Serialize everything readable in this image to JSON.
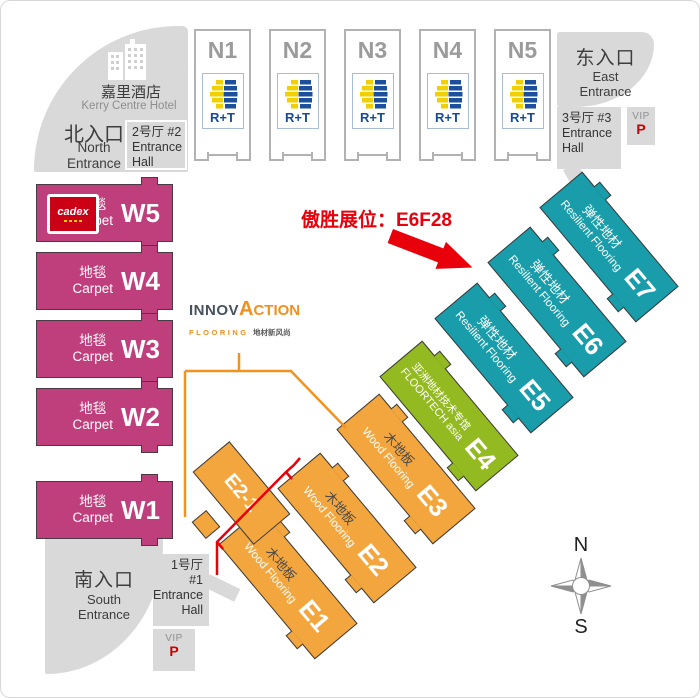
{
  "annotation": {
    "text": "傲胜展位：E6F28",
    "color": "#e8000b"
  },
  "hotel": {
    "zh": "嘉里酒店",
    "en": "Kerry Centre Hotel"
  },
  "entrances": {
    "north": {
      "zh": "北入口",
      "en_line1": "North",
      "en_line2": "Entrance"
    },
    "east": {
      "zh": "东入口",
      "en_line1": "East",
      "en_line2": "Entrance"
    },
    "south": {
      "zh": "南入口",
      "en_line1": "South",
      "en_line2": "Entrance"
    }
  },
  "entrance_halls": {
    "h2": {
      "line1": "2号厅  #2",
      "line2": "Entrance",
      "line3": "Hall"
    },
    "h3": {
      "line1": "3号厅  #3",
      "line2": "Entrance",
      "line3": "Hall"
    },
    "h1": {
      "line1": "1号厅",
      "line2": "#1",
      "line3": "Entrance",
      "line4": "Hall"
    }
  },
  "vip": {
    "label": "VIP",
    "parking": "P"
  },
  "north_halls": [
    {
      "code": "N1"
    },
    {
      "code": "N2"
    },
    {
      "code": "N3"
    },
    {
      "code": "N4"
    },
    {
      "code": "N5"
    }
  ],
  "rt_logo": {
    "label": "R+T"
  },
  "west_halls": [
    {
      "code": "W5",
      "zh": "地毯",
      "en": "Carpet"
    },
    {
      "code": "W4",
      "zh": "地毯",
      "en": "Carpet"
    },
    {
      "code": "W3",
      "zh": "地毯",
      "en": "Carpet"
    },
    {
      "code": "W2",
      "zh": "地毯",
      "en": "Carpet"
    },
    {
      "code": "W1",
      "zh": "地毯",
      "en": "Carpet"
    }
  ],
  "cadex_logo": {
    "label": "cadex"
  },
  "east_halls": [
    {
      "code": "E1",
      "zh": "木地板",
      "en": "Wood Flooring"
    },
    {
      "code": "E2",
      "zh": "木地板",
      "en": "Wood Flooring"
    },
    {
      "code": "E2-1"
    },
    {
      "code": "E3",
      "zh": "木地板",
      "en": "Wood Flooring"
    },
    {
      "code": "E4",
      "zh": "亚洲地材技术专馆",
      "en": "FLOORTECH asia"
    },
    {
      "code": "E5",
      "zh": "弹性地材",
      "en": "Resilient Flooring"
    },
    {
      "code": "E6",
      "zh": "弹性地材",
      "en": "Resilient Flooring"
    },
    {
      "code": "E7",
      "zh": "弹性地材",
      "en": "Resilient Flooring"
    }
  ],
  "innovaction_logo": {
    "part1": "INNOV",
    "part2": "A",
    "part3": "CTION",
    "sub_left": "FLOORING",
    "sub_right": "地材新风尚"
  },
  "compass": {
    "north": "N",
    "south": "S"
  },
  "colors": {
    "carpet": "#bf3e7c",
    "wood": "#f4a63e",
    "floortech": "#94ba21",
    "resilient": "#199daa",
    "highlight": "#e8000b",
    "entrance_gray": "#d9d9d9"
  }
}
